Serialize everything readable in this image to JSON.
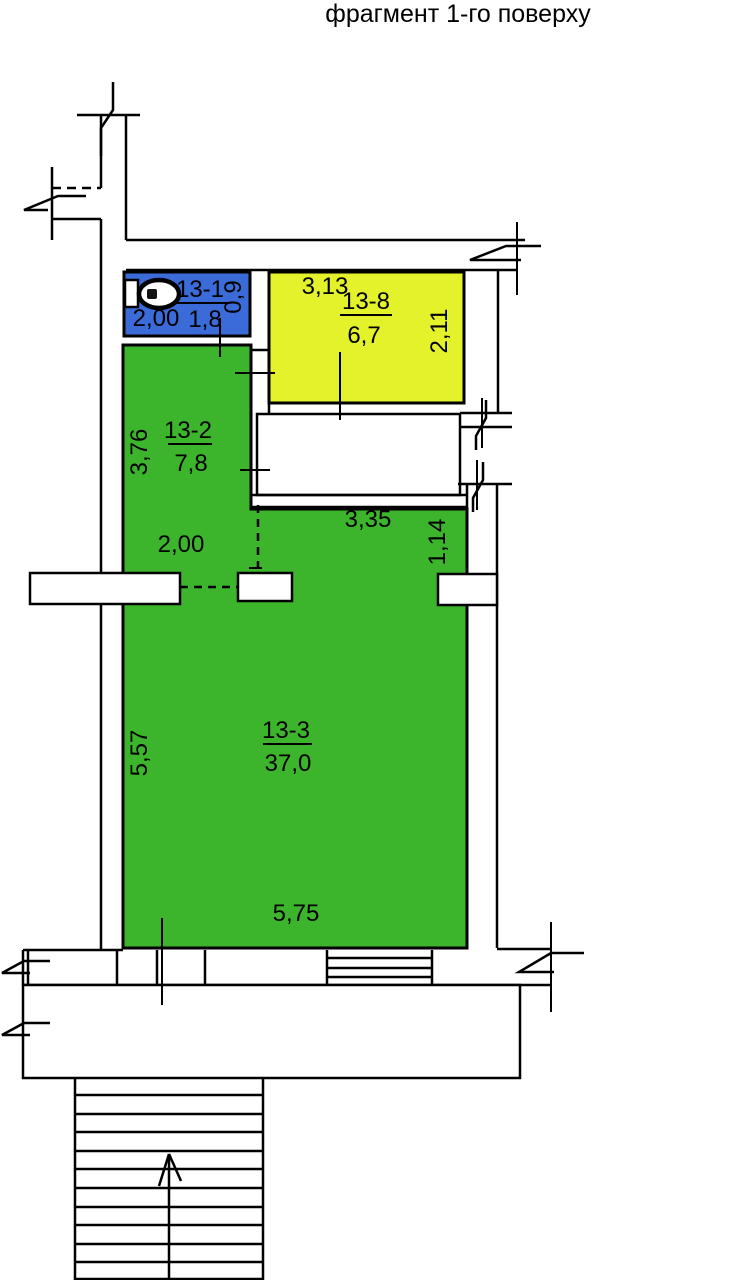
{
  "title": "фрагмент 1-го поверху",
  "colors": {
    "wc": "#3A6BD8",
    "storage": "#E4F22C",
    "living": "#3CB42C",
    "line": "#000000",
    "background": "#FFFFFF"
  },
  "rooms": {
    "wc": {
      "id": "13-1",
      "area": "1,8",
      "width": "2,00",
      "depth": "0,9"
    },
    "storage": {
      "id": "13-8",
      "area": "6,7",
      "width": "3,13",
      "depth": "2,11"
    },
    "hall": {
      "id": "13-2",
      "area": "7,8",
      "depth": "3,76",
      "opening": "2,00"
    },
    "main": {
      "id": "13-3",
      "area": "37,0",
      "depth": "5,57",
      "width": "5,75",
      "niche_width": "3,35",
      "niche_depth": "1,14"
    }
  },
  "icons": {
    "toilet": "wc-toilet",
    "stairs_direction": "arrow-up"
  }
}
